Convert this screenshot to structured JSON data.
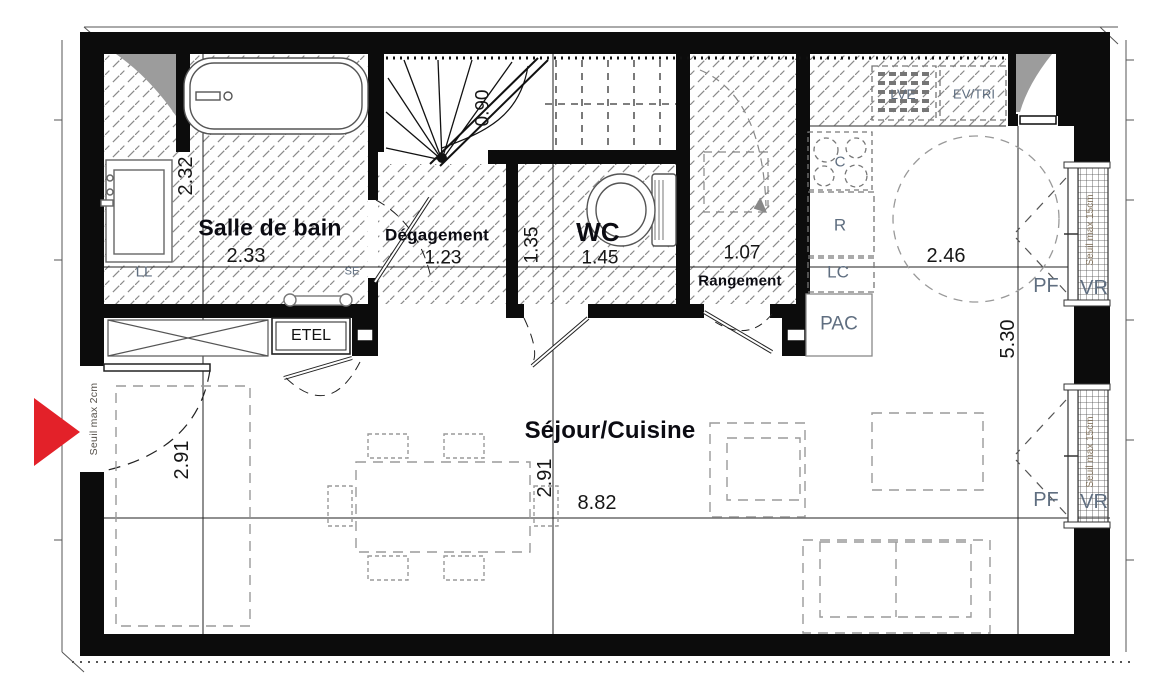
{
  "plan": {
    "rooms": {
      "bathroom": {
        "label": "Salle de bain",
        "width": "2.33",
        "depth": "2.32"
      },
      "hallway": {
        "label": "Dégagement",
        "width": "1.23"
      },
      "wc": {
        "label": "WC",
        "width": "1.45",
        "depth": "1.35"
      },
      "storage": {
        "label": "Rangement",
        "width": "1.07"
      },
      "living": {
        "label": "Séjour/Cuisine",
        "width": "8.82",
        "depth_left": "2.91",
        "depth_mid": "2.91",
        "depth_right": "5.30"
      },
      "kitchen": {
        "width": "2.46"
      }
    },
    "stair": {
      "width": "0.90"
    },
    "equipment": {
      "washing_machine": "LL",
      "towel_dryer": "SE",
      "electrical_box": "ETEL",
      "dishwasher": "LVE",
      "sink_sorting": "EV/TRI",
      "hob": "C",
      "fridge": "R",
      "lc": "LC",
      "heat_pump": "PAC"
    },
    "windows": {
      "french_door": "PF",
      "roller_shutter": "VR",
      "threshold_note": "Seuil max 15cm"
    },
    "entrance": {
      "threshold_note": "Seuil max 2cm"
    },
    "colors": {
      "arrow_red": "#e32129",
      "equipment_label": "#5f6e80",
      "wall_black": "#0c0c0c",
      "hatch_gray": "#8a8a8a"
    }
  }
}
